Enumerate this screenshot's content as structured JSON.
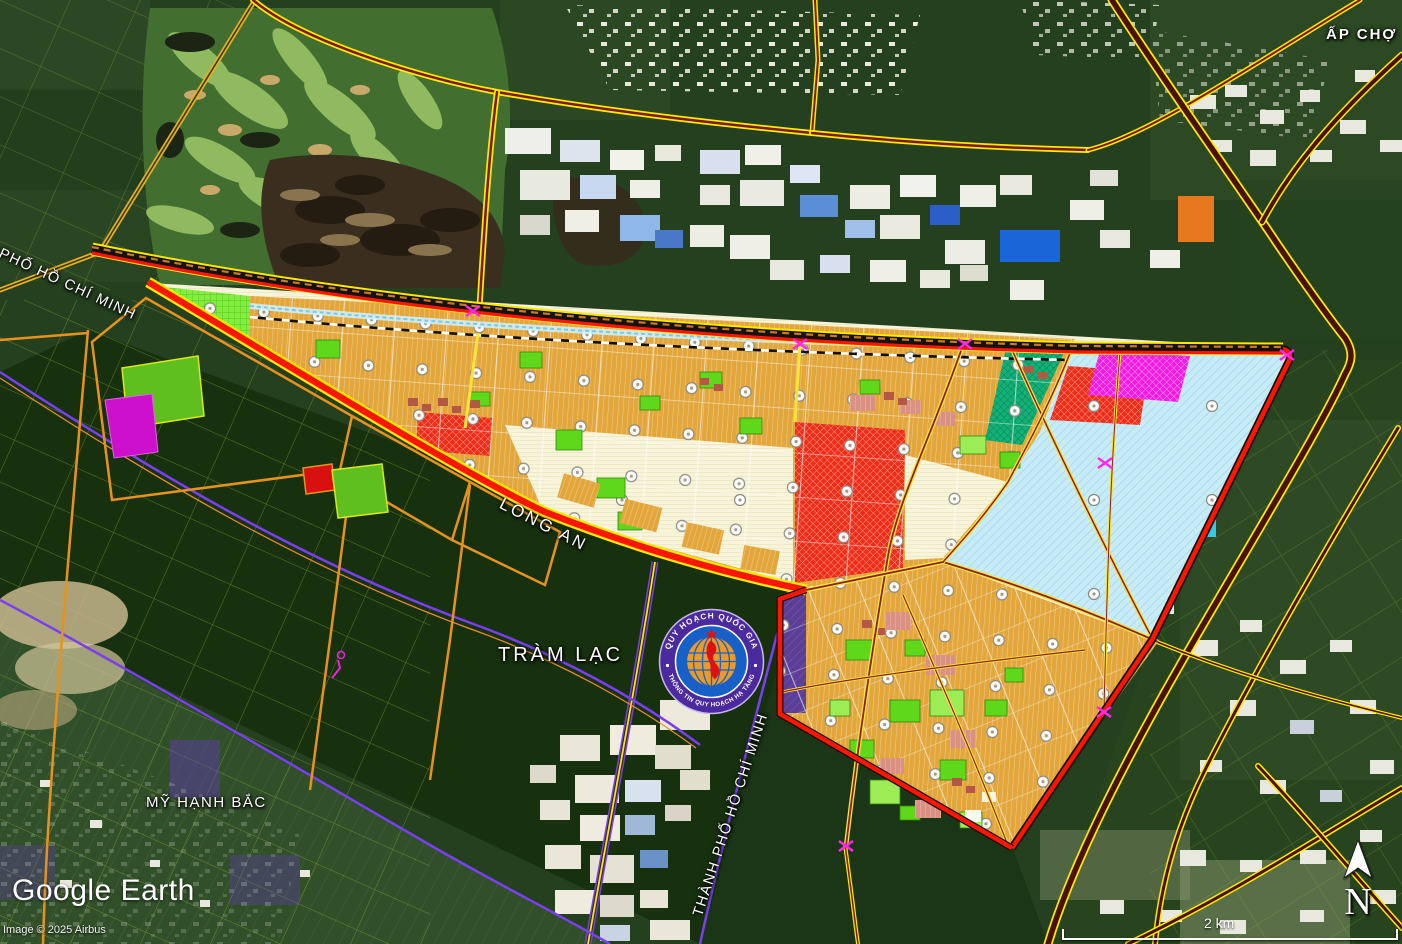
{
  "map": {
    "labels": {
      "ap_cho": "ẤP CHỢ",
      "tram_lac": "TRÀM LẠC",
      "my_hanh_bac": "MỸ HẠNH BẮC",
      "long_an": "LONG AN",
      "hcmc": "THÀNH PHỐ HỒ CHÍ MINH"
    },
    "badge": {
      "top_text": "QUY HOẠCH QUỐC GIA",
      "bottom_text": "THÔNG TIN QUY HOẠCH HẠ TẦNG"
    },
    "attribution": {
      "logo": "Google Earth",
      "copyright": "Image © 2025 Airbus"
    },
    "scale_bar_label": "2 km",
    "compass_label": "N",
    "palette": {
      "zone_boundary_red": "#ff1500",
      "road_yellow": "#ffe800",
      "road_core_maroon": "#7a1a08",
      "residential_orange": "#e2a63b",
      "mixed_use_cream": "#f7f4da",
      "water_cyan": "#c7ebf7",
      "industry_red": "#ee2d18",
      "commercial_magenta": "#f21ce0",
      "park_lime": "#82ee3f",
      "green_space": "#5fd81c",
      "admin_purple": "#5b3e96",
      "boundary_purple": "#7a3ff0",
      "teal_zone": "#12b178"
    }
  }
}
